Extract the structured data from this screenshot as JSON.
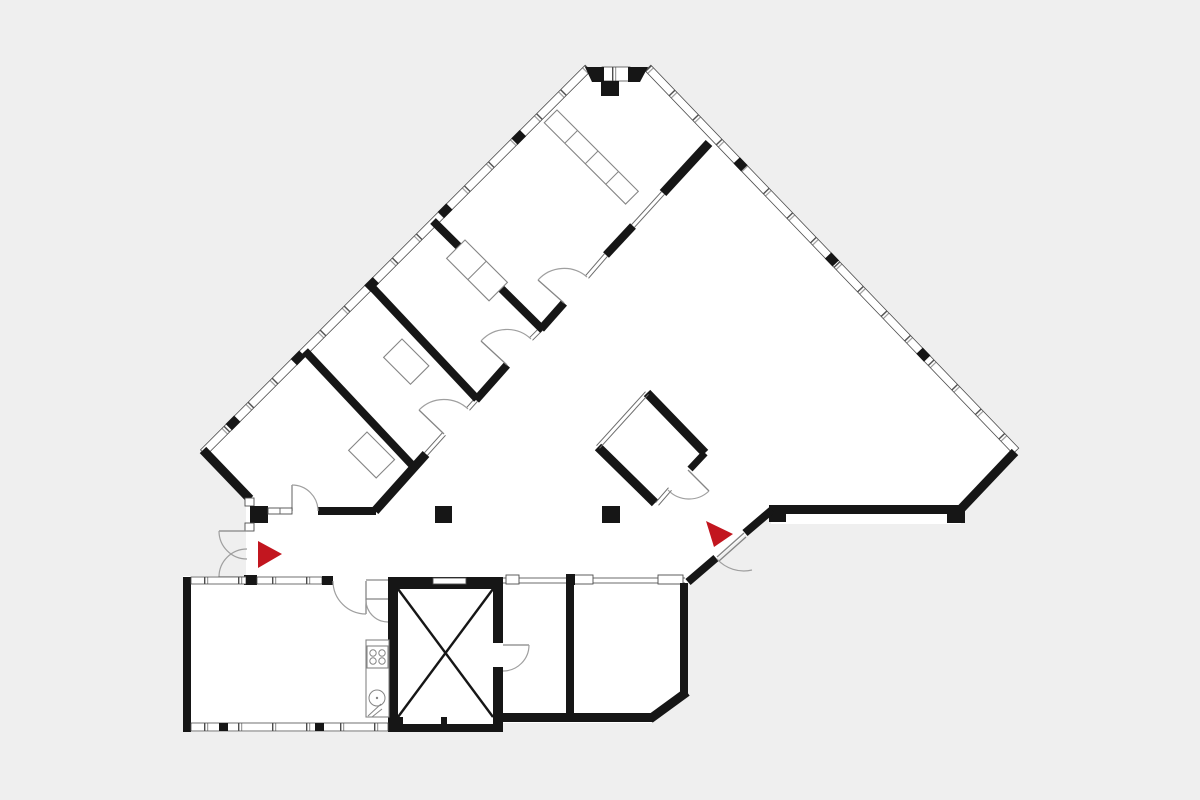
{
  "meta": {
    "kind": "architectural-floor-plan",
    "description": "Black and white office floor plan: V-shaped glazed wing with four offices along a diagonal corridor, large open space, rotated square meeting room, lower annex with large room, kitchenette, X-marked shaft and two rooms; two red entrance arrows."
  },
  "colors": {
    "background": "#efefef",
    "floor": "#ffffff",
    "wall": "#161616",
    "line": "#4d4d4d",
    "glass": "#6b6b6b",
    "door_arc": "#9f9f9f",
    "fixture": "#858585",
    "entrance_marker": "#c2161f"
  },
  "plan": {
    "wings": [
      "northwest-glazed-wing",
      "northeast-glazed-wing",
      "south-annex"
    ],
    "rooms": [
      {
        "name": "office-1"
      },
      {
        "name": "office-2"
      },
      {
        "name": "office-3"
      },
      {
        "name": "office-4"
      },
      {
        "name": "corridor"
      },
      {
        "name": "open-space"
      },
      {
        "name": "angled-meeting-room"
      },
      {
        "name": "shaft-room-x"
      },
      {
        "name": "kitchenette"
      },
      {
        "name": "annex-large-room"
      },
      {
        "name": "annex-room-1"
      },
      {
        "name": "annex-room-2"
      }
    ],
    "markers": [
      {
        "name": "entrance-arrow-west",
        "shape": "triangle",
        "points": "east"
      },
      {
        "name": "entrance-arrow-southeast",
        "shape": "triangle",
        "points": "east-southeast"
      }
    ],
    "fixtures": [
      {
        "name": "stove",
        "burners": 4
      },
      {
        "name": "sink",
        "basins": 1
      },
      {
        "name": "cabinet-row-apex",
        "cells": 4
      },
      {
        "name": "cabinet-row-office-3",
        "cells": 2
      },
      {
        "name": "desk-office-1"
      },
      {
        "name": "desk-office-2"
      }
    ],
    "columns": 4,
    "pilasters": 2,
    "doors": 12
  }
}
